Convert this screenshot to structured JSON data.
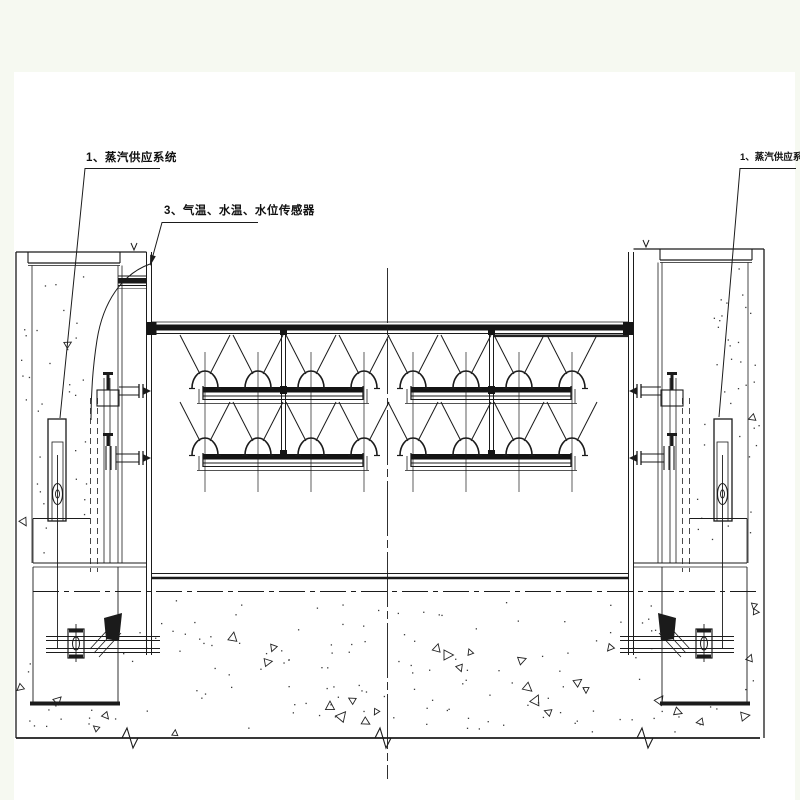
{
  "drawing": {
    "labels": {
      "steam_left": "1、蒸汽供应系统",
      "sensors": "3、气温、水温、水位传感器",
      "steam_right": "1、蒸汽供应系统"
    },
    "colors": {
      "page_bg": "#f6f9f1",
      "sheet_bg": "#ffffff",
      "line": "#1b1b1b"
    }
  }
}
